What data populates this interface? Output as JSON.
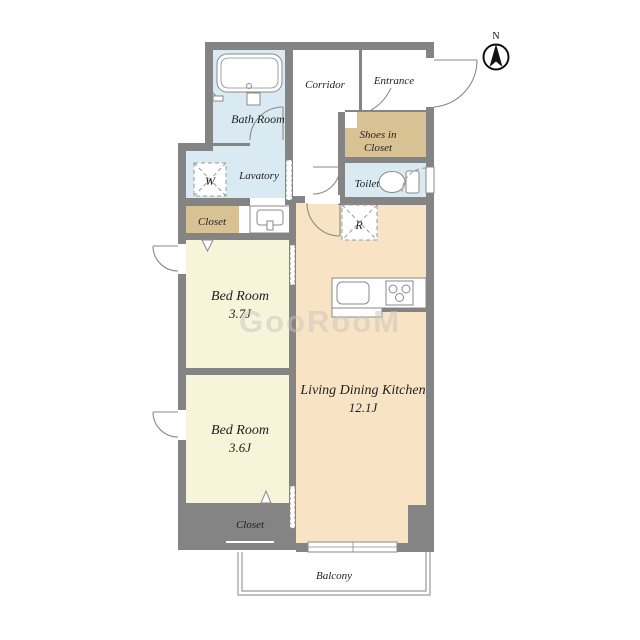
{
  "plan_title": "2LDK apartment floor plan",
  "palette": {
    "wall": "#848484",
    "water_room": "#daeaf3",
    "bedroom": "#f8f4da",
    "ldk": "#f8e3c4",
    "closet": "#d8c193",
    "white": "#ffffff",
    "fixture_line": "#8a8a8a",
    "balcony_line": "#9a9a9a",
    "text": "#1f1f1f",
    "watermark_color": "#c8c5c0"
  },
  "compass": {
    "label": "N"
  },
  "watermark": {
    "text": "GooRooM"
  },
  "rooms": {
    "bath": {
      "label": "Bath Room"
    },
    "corridor": {
      "label": "Corridor"
    },
    "entrance": {
      "label": "Entrance"
    },
    "shoes_closet": {
      "line1": "Shoes in",
      "line2": "Closet"
    },
    "lavatory": {
      "label": "Lavatory"
    },
    "toilet": {
      "label": "Toilet"
    },
    "washer": {
      "label": "W"
    },
    "fridge": {
      "label": "R"
    },
    "closet_upper": {
      "label": "Closet"
    },
    "closet_lower": {
      "label": "Closet"
    },
    "bedroom1": {
      "name": "Bed Room",
      "size": "3.7J"
    },
    "bedroom2": {
      "name": "Bed Room",
      "size": "3.6J"
    },
    "ldk": {
      "name": "Living Dining Kitchen",
      "size": "12.1J"
    },
    "balcony": {
      "label": "Balcony"
    }
  }
}
